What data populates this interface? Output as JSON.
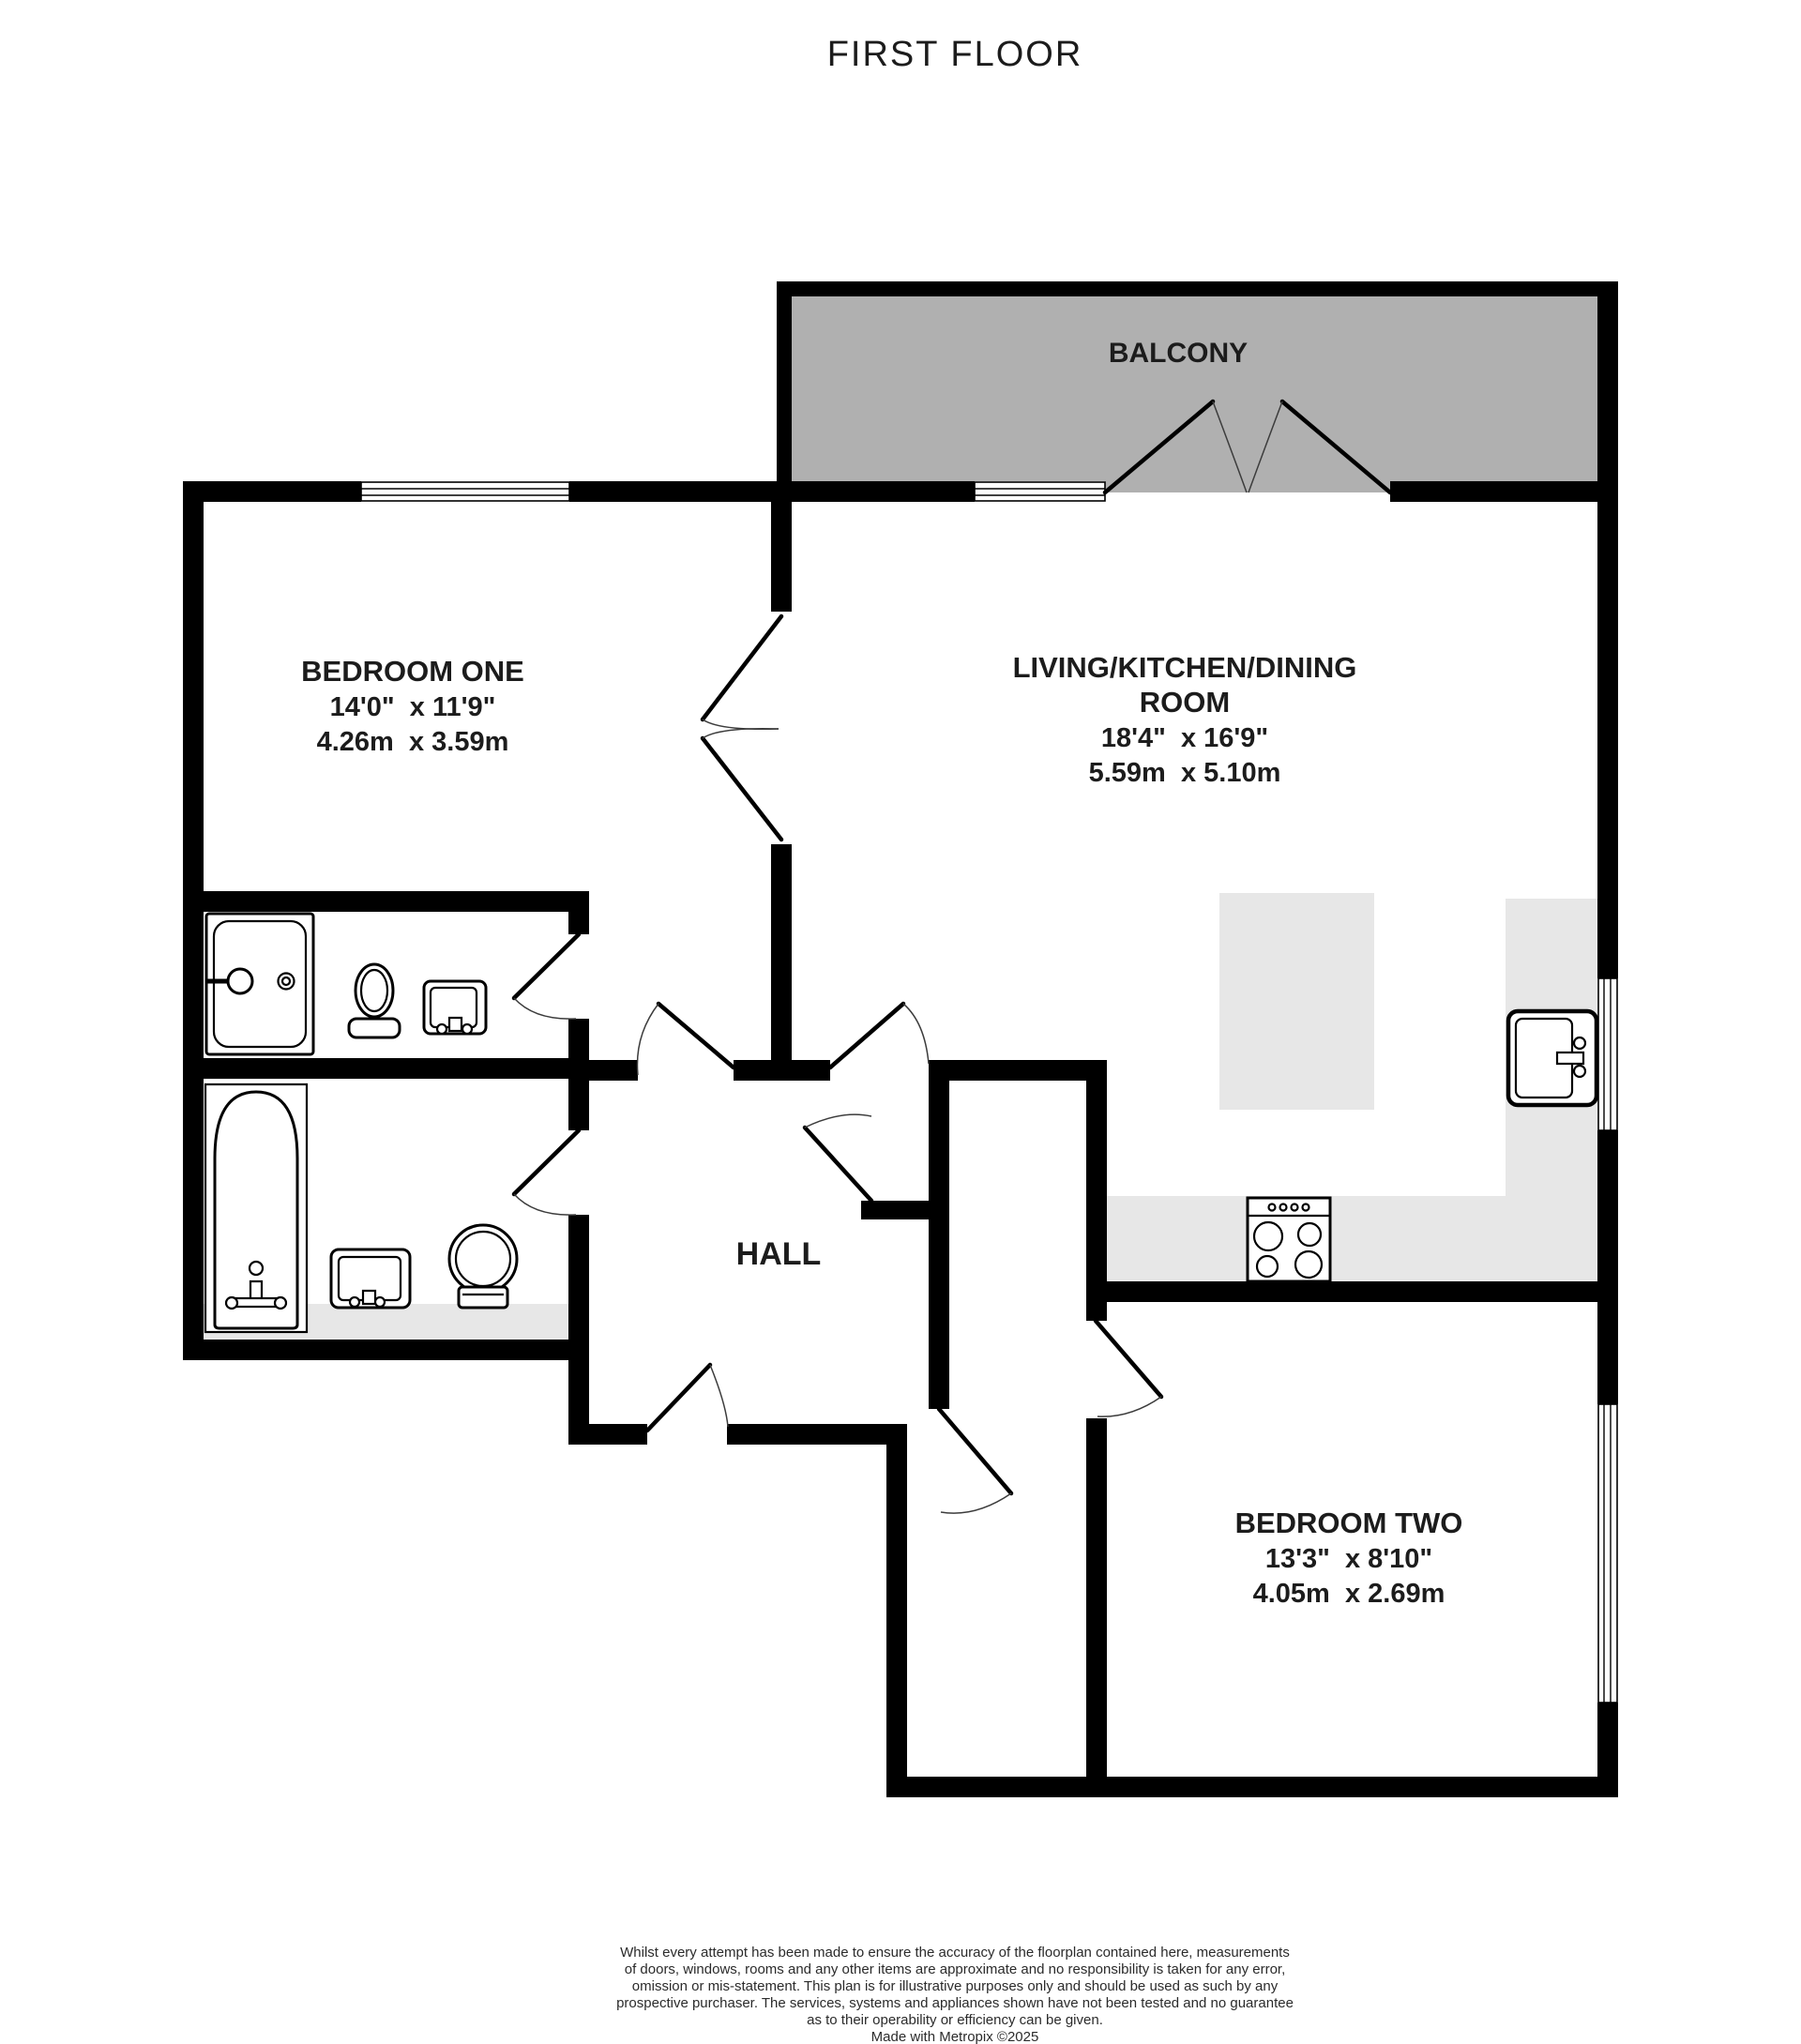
{
  "title": "FIRST FLOOR",
  "plan": {
    "balcony": {
      "label": "BALCONY"
    },
    "bedroom_one": {
      "name": "BEDROOM ONE",
      "imperial": "14'0\"  x 11'9\"",
      "metric": "4.26m  x 3.59m"
    },
    "living": {
      "name_line1": "LIVING/KITCHEN/DINING",
      "name_line2": "ROOM",
      "imperial": "18'4\"  x 16'9\"",
      "metric": "5.59m  x 5.10m"
    },
    "hall": {
      "name": "HALL"
    },
    "bedroom_two": {
      "name": "BEDROOM TWO",
      "imperial": "13'3\"  x 8'10\"",
      "metric": "4.05m  x 2.69m"
    },
    "fixtures": [
      "shower",
      "toilet",
      "washbasin",
      "bathtub",
      "washbasin",
      "toilet",
      "kitchen-sink",
      "stove"
    ],
    "colors": {
      "wall": "#000000",
      "balconyFill": "#b0b0b0",
      "counterFill": "#e7e7e7",
      "text": "#1c1c1c",
      "arc": "#3c3c3c"
    }
  },
  "footer": {
    "lines": [
      "Whilst every attempt has been made to ensure the accuracy of the floorplan contained here, measurements",
      "of doors, windows, rooms and any other items are approximate and no responsibility is taken for any error,",
      "omission or mis-statement. This plan is for illustrative purposes only and should be used as such by any",
      "prospective purchaser. The services, systems and appliances shown have not been tested and no guarantee",
      "as to their operability or efficiency can be given.",
      "Made with Metropix ©2025"
    ]
  }
}
